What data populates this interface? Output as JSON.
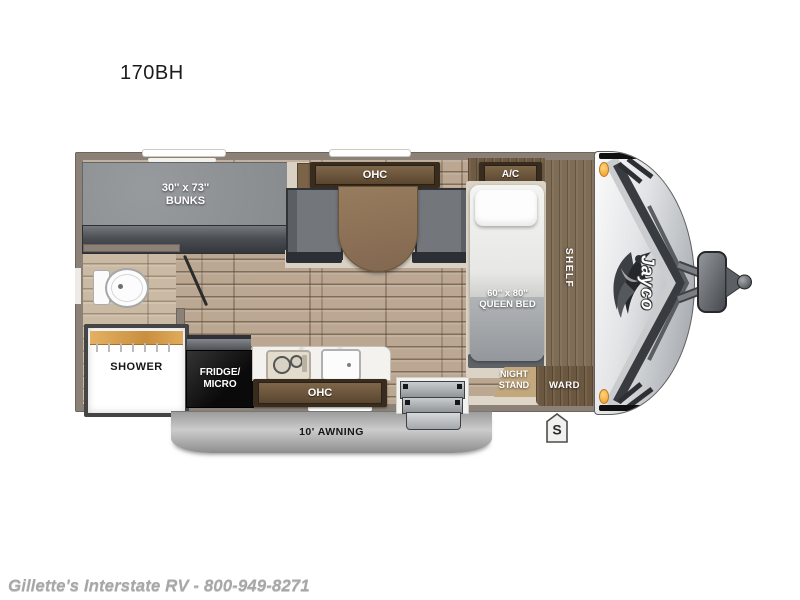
{
  "model": "170BH",
  "footer": "Gillette's Interstate RV - 800-949-8271",
  "brand": "Jayco",
  "badge": "S",
  "rooms": {
    "bunks": {
      "size": "30'' x 73''",
      "name": "BUNKS"
    },
    "dinette_ohc": "OHC",
    "ac": "A/C",
    "shelf": "SHELF",
    "queen_bed": {
      "size": "60'' x 80''",
      "name": "QUEEN BED"
    },
    "shower": "SHOWER",
    "fridge": {
      "line1": "FRIDGE/",
      "line2": "MICRO"
    },
    "kitchen_ohc": "OHC",
    "nightstand": {
      "line1": "NIGHT",
      "line2": "STAND"
    },
    "ward": "WARD",
    "awning": "10' AWNING"
  },
  "colors": {
    "wall": "#8b8177",
    "floor_wood": "#b7a28c",
    "cabinet_brown": "#5a462f",
    "bench_gray": "#73777b",
    "marker_light_orange": "#f2a23c",
    "awning_gray": "#b5b5b5",
    "cap_silver": "#d9dadc",
    "fridge_black": "#141414"
  }
}
